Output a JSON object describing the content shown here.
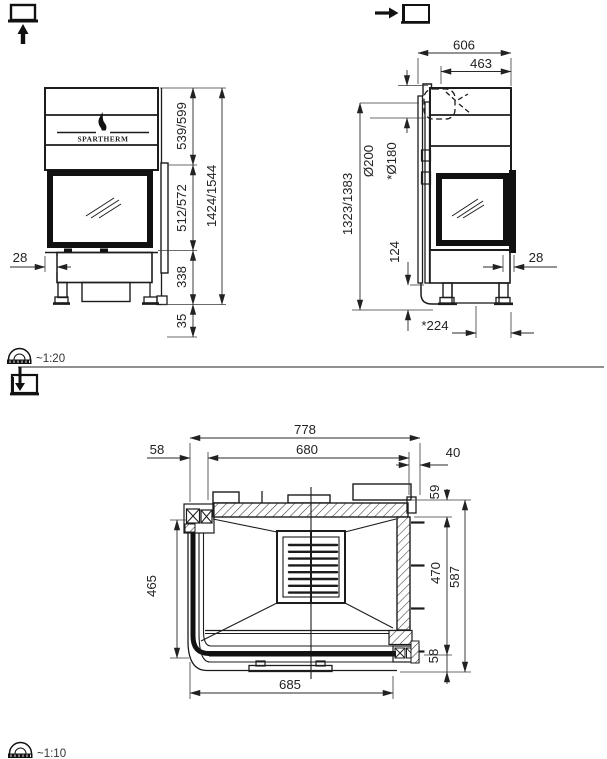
{
  "drawing": {
    "brand": "SPARTHERM",
    "scales": {
      "upper": "~1:20",
      "lower": "~1:10"
    },
    "front": {
      "dim_left_inset": "28",
      "dim_top_section": "539/599",
      "dim_glass_section": "512/572",
      "dim_base_section": "338",
      "dim_feet": "35",
      "dim_total_height": "1424/1544"
    },
    "side": {
      "dim_depth": "606",
      "dim_flue_center": "463",
      "dim_flue_outer": "Ø200",
      "dim_flue_inner": "*Ø180",
      "dim_flue_height": "1323/1383",
      "dim_plinth": "124",
      "dim_front_lip": "28",
      "dim_base_depth": "*224"
    },
    "plan": {
      "dim_total_width": "778",
      "dim_inner_width": "680",
      "dim_left": "58",
      "dim_right": "40",
      "dim_back": "59",
      "dim_side": "470",
      "dim_total_depth": "587",
      "dim_glass_side": "465",
      "dim_front_width": "685",
      "dim_front_edge": "58"
    }
  }
}
